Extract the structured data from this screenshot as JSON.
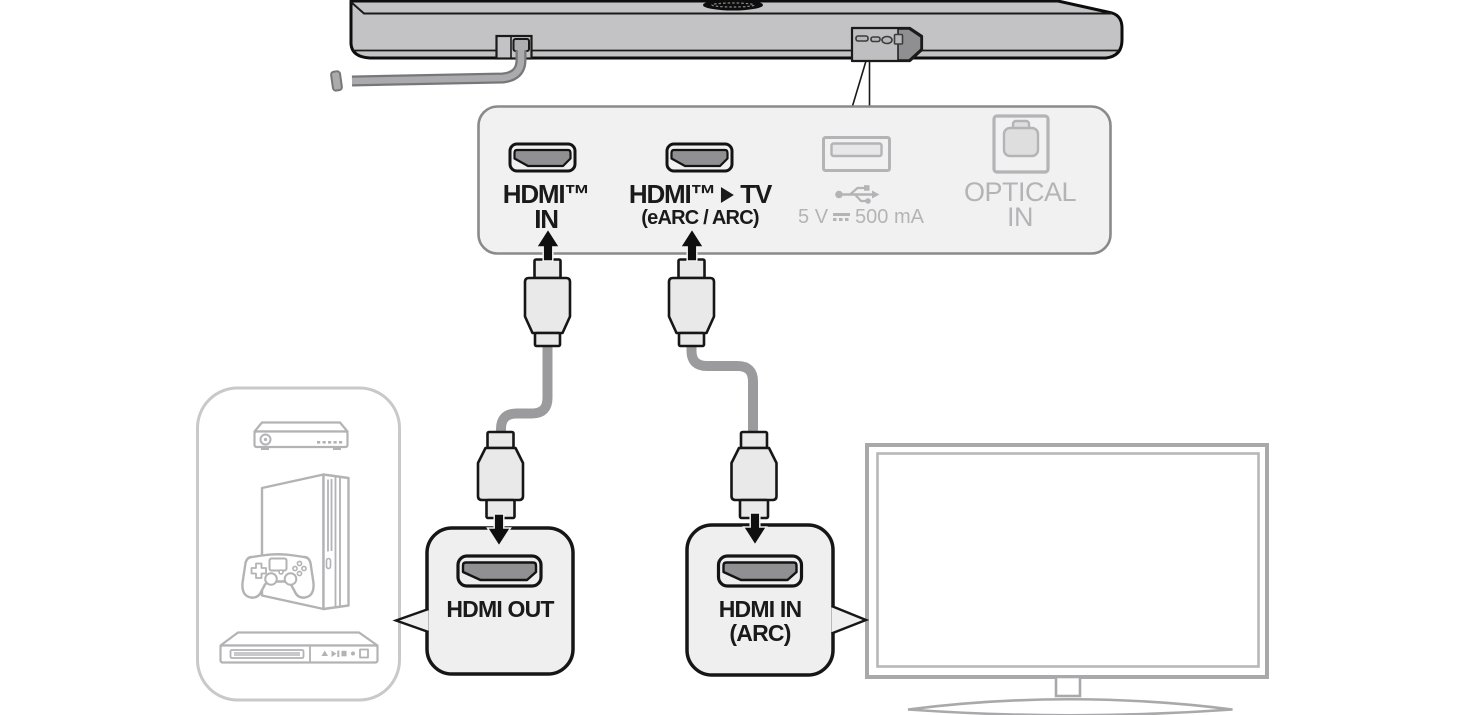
{
  "panel": {
    "hdmi_in": {
      "line1": "HDMI™",
      "line2": "IN"
    },
    "hdmi_tv": {
      "part1": "HDMI™",
      "part2": "TV",
      "line2": "(eARC / ARC)"
    },
    "usb": {
      "prefix": "5 V",
      "suffix": "500 mA"
    },
    "optical": {
      "line1": "OPTICAL",
      "line2": "IN"
    }
  },
  "callouts": {
    "hdmi_out": {
      "label": "HDMI OUT"
    },
    "hdmi_in_arc": {
      "line1": "HDMI IN",
      "line2": "(ARC)"
    }
  },
  "colors": {
    "outline_black": "#161616",
    "soundbar_gray": "#c3c3c5",
    "recess_shadow_gray": "#8f8f91",
    "panel_fill": "#f1f1f2",
    "panel_border": "#8a8a8c",
    "inactive_port_gray": "#b4b4b6",
    "hdmi_plug_gray": "#909092",
    "cable_gray": "#9b9b9d",
    "connector_fill": "#e9e9ea",
    "callout_box_fill": "#efefef",
    "device_icon_gray": "#b3b3b5",
    "device_box_border": "#c9c9cb",
    "tv_frame_gray": "#a9a9ab",
    "label_text": "#1a1a1a"
  }
}
